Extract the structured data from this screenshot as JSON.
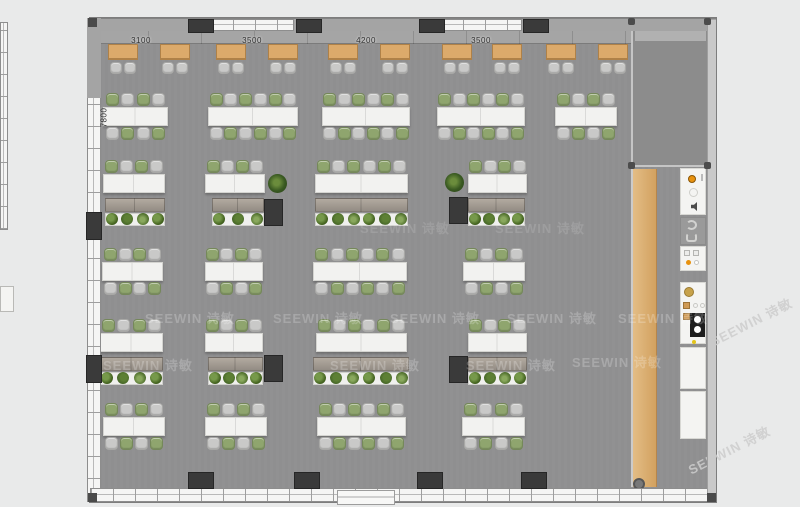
{
  "title": "Office open-plan furniture layout (top view render)",
  "palette": {
    "background": "#e9eaea",
    "floor": "#8f8f90",
    "pillar": "#3a3a3a",
    "wood_walkway": "#d8ab72",
    "booth_desk": "#dcaa6b",
    "table": "#f2f2f0",
    "chair_gray": "#c9c9c8",
    "chair_green": "#8fa56e",
    "cabinet": "#a39b92",
    "plant_dark": "#33501f",
    "accent_orange": "#e8920f"
  },
  "watermark": {
    "text": "SEEWIN 诗敏",
    "band_instances": [
      {
        "x": 145,
        "y": 308,
        "opacity": 0.22
      },
      {
        "x": 273,
        "y": 308,
        "opacity": 0.2
      },
      {
        "x": 390,
        "y": 308,
        "opacity": 0.22
      },
      {
        "x": 507,
        "y": 308,
        "opacity": 0.22
      },
      {
        "x": 618,
        "y": 308,
        "opacity": 0.22
      },
      {
        "x": 103,
        "y": 355,
        "opacity": 0.22
      },
      {
        "x": 330,
        "y": 355,
        "opacity": 0.22
      },
      {
        "x": 466,
        "y": 355,
        "opacity": 0.22
      },
      {
        "x": 572,
        "y": 352,
        "opacity": 0.22
      },
      {
        "x": 360,
        "y": 218,
        "opacity": 0.13
      },
      {
        "x": 495,
        "y": 218,
        "opacity": 0.13
      }
    ],
    "diagonal_instances": [
      {
        "x": 706,
        "y": 312
      },
      {
        "x": 684,
        "y": 440
      }
    ]
  },
  "dimensions": {
    "top": [
      {
        "label": "3100"
      },
      {
        "label": "3500"
      },
      {
        "label": "4200"
      },
      {
        "label": "3500"
      }
    ],
    "side": [
      {
        "label": "7800"
      }
    ]
  },
  "furniture": {
    "booth_desks": [
      {
        "x": 108
      },
      {
        "x": 160
      },
      {
        "x": 216
      },
      {
        "x": 268
      },
      {
        "x": 328
      },
      {
        "x": 380
      },
      {
        "x": 442
      },
      {
        "x": 492
      },
      {
        "x": 546
      },
      {
        "x": 598
      }
    ],
    "workstations": [
      {
        "x": 103,
        "y": 107,
        "w": 65,
        "seats": 4,
        "double": true
      },
      {
        "x": 208,
        "y": 107,
        "w": 90,
        "seats": 6,
        "double": true
      },
      {
        "x": 322,
        "y": 107,
        "w": 88,
        "seats": 6,
        "double": true
      },
      {
        "x": 437,
        "y": 107,
        "w": 88,
        "seats": 6,
        "double": true
      },
      {
        "x": 555,
        "y": 107,
        "w": 62,
        "seats": 4,
        "double": true
      },
      {
        "x": 103,
        "y": 174,
        "w": 62,
        "seats": 4,
        "double": false
      },
      {
        "x": 205,
        "y": 174,
        "w": 60,
        "seats": 4,
        "double": false
      },
      {
        "x": 315,
        "y": 174,
        "w": 93,
        "seats": 6,
        "double": false
      },
      {
        "x": 468,
        "y": 174,
        "w": 59,
        "seats": 4,
        "double": false
      },
      {
        "x": 102,
        "y": 262,
        "w": 61,
        "seats": 4,
        "double": true
      },
      {
        "x": 205,
        "y": 262,
        "w": 58,
        "seats": 4,
        "double": true
      },
      {
        "x": 313,
        "y": 262,
        "w": 94,
        "seats": 6,
        "double": true
      },
      {
        "x": 463,
        "y": 262,
        "w": 62,
        "seats": 4,
        "double": true
      },
      {
        "x": 100,
        "y": 333,
        "w": 63,
        "seats": 4,
        "double": false
      },
      {
        "x": 205,
        "y": 333,
        "w": 58,
        "seats": 4,
        "double": false
      },
      {
        "x": 316,
        "y": 333,
        "w": 91,
        "seats": 6,
        "double": false
      },
      {
        "x": 468,
        "y": 333,
        "w": 59,
        "seats": 4,
        "double": false
      },
      {
        "x": 103,
        "y": 417,
        "w": 62,
        "seats": 4,
        "double": true
      },
      {
        "x": 205,
        "y": 417,
        "w": 62,
        "seats": 4,
        "double": true
      },
      {
        "x": 317,
        "y": 417,
        "w": 89,
        "seats": 6,
        "double": true
      },
      {
        "x": 462,
        "y": 417,
        "w": 63,
        "seats": 4,
        "double": true
      }
    ],
    "storage_units": [
      {
        "x": 105,
        "y": 198,
        "w": 60,
        "plants": 4
      },
      {
        "x": 212,
        "y": 198,
        "w": 52,
        "plants": 3
      },
      {
        "x": 315,
        "y": 198,
        "w": 93,
        "plants": 6
      },
      {
        "x": 468,
        "y": 198,
        "w": 57,
        "plants": 4
      },
      {
        "x": 100,
        "y": 357,
        "w": 63,
        "plants": 4
      },
      {
        "x": 208,
        "y": 357,
        "w": 55,
        "plants": 4
      },
      {
        "x": 313,
        "y": 357,
        "w": 96,
        "plants": 6
      },
      {
        "x": 468,
        "y": 357,
        "w": 59,
        "plants": 4
      }
    ],
    "pillars": {
      "top": [
        188,
        296,
        419,
        523
      ],
      "bottom": [
        188,
        294,
        417,
        521
      ],
      "left_wall": [
        212,
        355
      ],
      "floor": [
        {
          "x": 264,
          "y": 199
        },
        {
          "x": 449,
          "y": 197
        },
        {
          "x": 264,
          "y": 355
        },
        {
          "x": 449,
          "y": 356
        }
      ]
    },
    "plants_floor": [
      {
        "x": 268,
        "y": 174
      },
      {
        "x": 445,
        "y": 173
      }
    ]
  },
  "kitchen": {
    "x": 680,
    "w": 26,
    "panels": [
      {
        "y": 168,
        "h": 47,
        "type": "sink"
      },
      {
        "y": 217,
        "h": 28,
        "type": "lounge"
      },
      {
        "y": 246,
        "h": 25,
        "type": "dispenser"
      },
      {
        "y": 282,
        "h": 62,
        "type": "coffee"
      },
      {
        "y": 347,
        "h": 42,
        "type": "counter"
      },
      {
        "y": 391,
        "h": 48,
        "type": "counter"
      }
    ]
  }
}
